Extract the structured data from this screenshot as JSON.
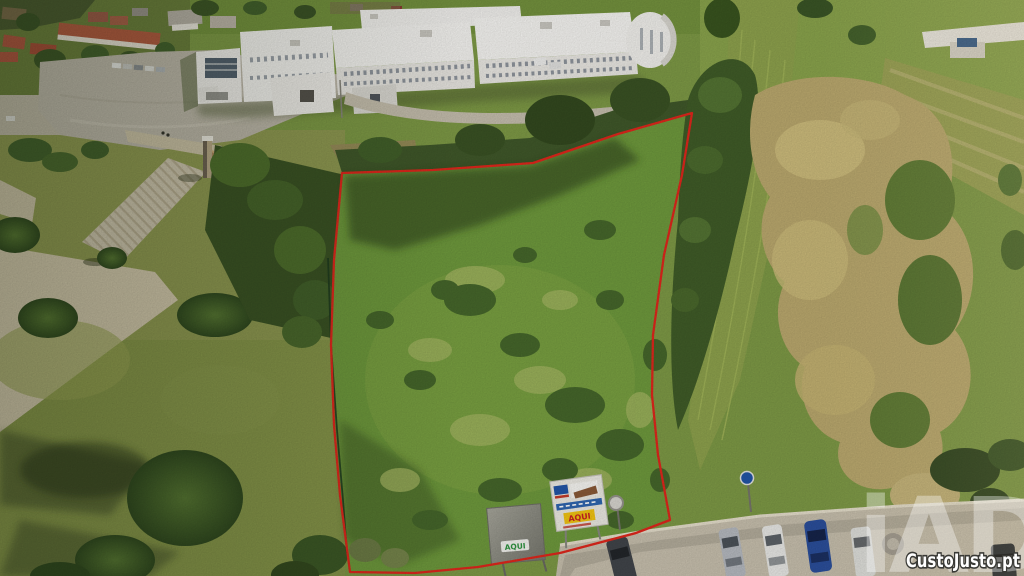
{
  "watermarks": {
    "agency_logo": "iAD",
    "site_logo": "CustoJusto.pt"
  },
  "signs": {
    "gray_sign": {
      "label": "AQUI"
    },
    "white_sign": {
      "label": "AQUI"
    }
  },
  "colors": {
    "boundary_red": "#e1271c",
    "secondary_boundary_green": "#1d3a1e",
    "sign_label_green": "#2e9440",
    "sign_label_red": "#cc2222",
    "sign_yellow_bg": "#f2c412",
    "sign_strip_blue": "#2f66b0",
    "watermark_white": "#ffffff"
  }
}
